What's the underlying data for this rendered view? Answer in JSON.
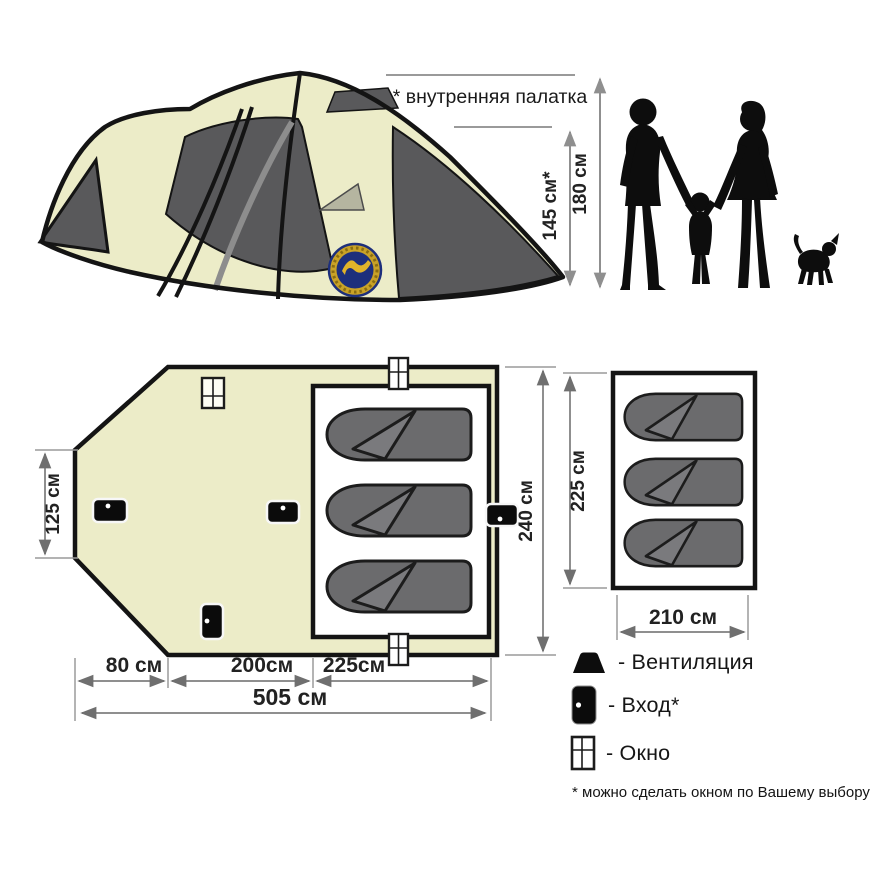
{
  "title": "Схема палатки",
  "palette": {
    "fabric_cream": "#ececc8",
    "panel_gray": "#59595b",
    "sage": "#b5b5a0",
    "bag_gray": "#6b6b6d",
    "bag_flap": "#7a7a7d",
    "outline": "#141414",
    "dim_line": "#8f8f8f",
    "logo_navy": "#1d2f7c",
    "logo_gold": "#c9a227"
  },
  "tent_view": {
    "note": "* внутренняя палатка",
    "inner_height": "145 см*",
    "outer_height": "180 см"
  },
  "plan_main": {
    "left_height": "125 см",
    "depth": "240 см",
    "segments": [
      "80 см",
      "200см",
      "225см"
    ],
    "total": "505 см"
  },
  "plan_inner": {
    "depth": "225 см",
    "width": "210 см"
  },
  "legend": {
    "items": [
      {
        "icon": "vent-icon",
        "label": "- Вентиляция"
      },
      {
        "icon": "door-icon",
        "label": "- Вход*"
      },
      {
        "icon": "window-icon",
        "label": "- Окно"
      }
    ],
    "footnote": "* можно сделать окном по Вашему выбору"
  }
}
